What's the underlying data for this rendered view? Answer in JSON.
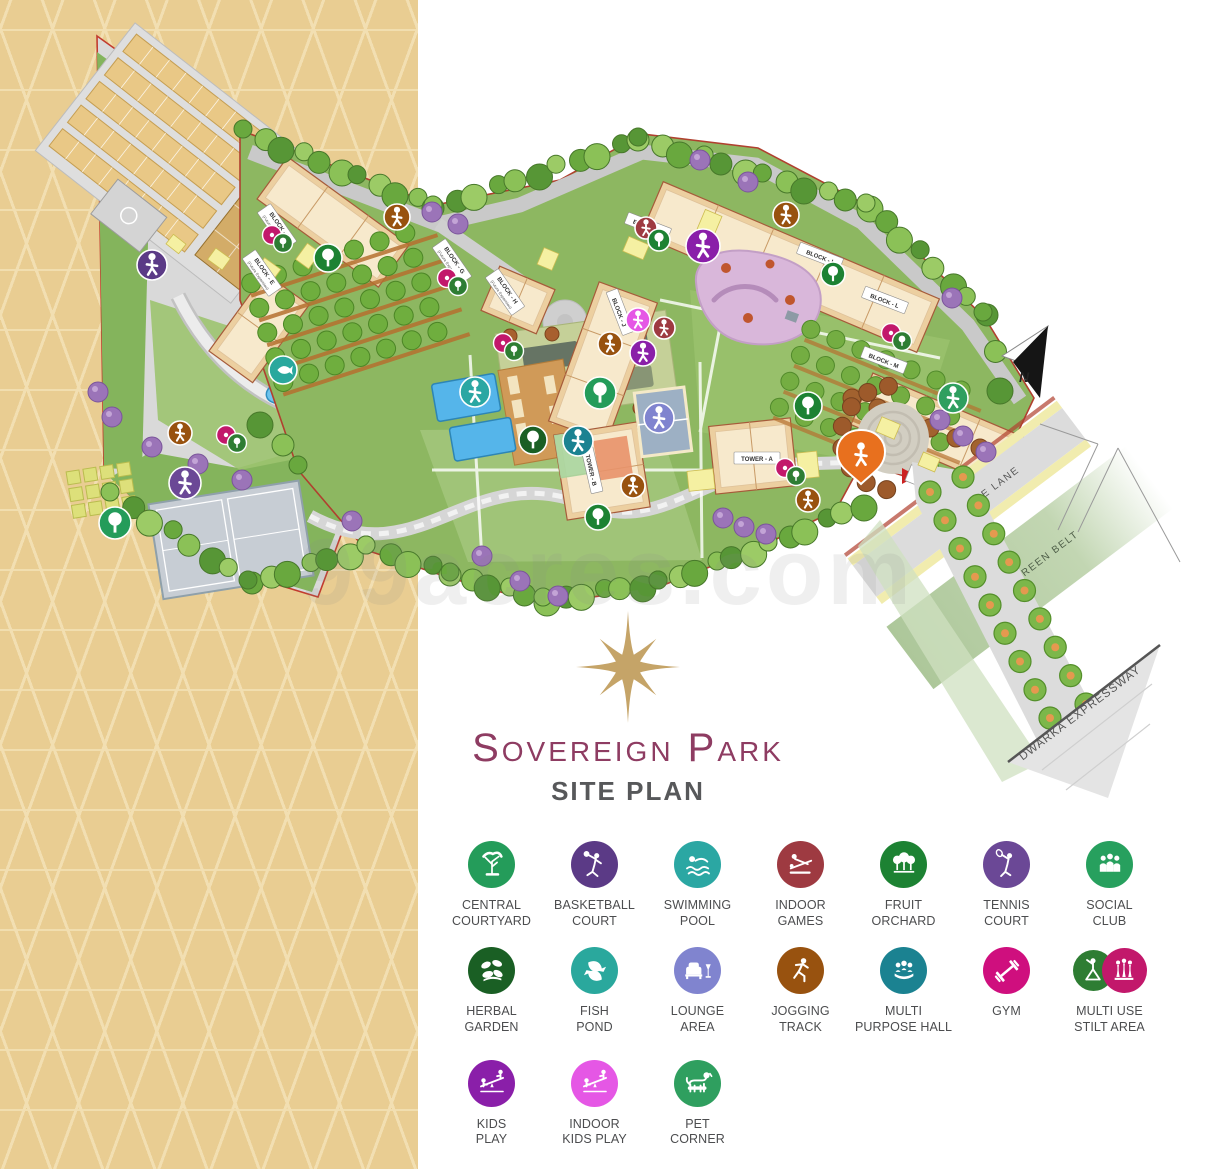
{
  "title": {
    "name": "Sovereign Park",
    "subtitle": "SITE PLAN"
  },
  "watermark": "99acres.com",
  "map": {
    "north_label": "N",
    "service_lane": "SERVICE LANE",
    "green_belt": "GREEN BELT",
    "expressway": "DWARKA EXPRESSWAY",
    "blocks": [
      {
        "label": "BLOCK - E",
        "sub": "(Future Expansion)"
      },
      {
        "label": "BLOCK - F",
        "sub": "(Future Expansion)"
      },
      {
        "label": "BLOCK - G",
        "sub": "(Future Expansion)"
      },
      {
        "label": "BLOCK - H",
        "sub": "(Future Expansion)"
      },
      {
        "label": "BLOCK - B",
        "sub": ""
      },
      {
        "label": "BLOCK - J",
        "sub": ""
      },
      {
        "label": "BLOCK - I",
        "sub": ""
      },
      {
        "label": "BLOCK - L",
        "sub": ""
      },
      {
        "label": "BLOCK - M",
        "sub": ""
      },
      {
        "label": "TOWER - A",
        "sub": ""
      },
      {
        "label": "TOWER - B",
        "sub": ""
      }
    ]
  },
  "legend": {
    "items": [
      {
        "key": "central-courtyard",
        "label": "CENTRAL\nCOURTYARD",
        "color": "#249c5a",
        "glyph": "tree"
      },
      {
        "key": "basketball-court",
        "label": "BASKETBALL\nCOURT",
        "color": "#5b3a86",
        "glyph": "basketball"
      },
      {
        "key": "swimming-pool",
        "label": "SWIMMING\nPOOL",
        "color": "#2ba7a3",
        "glyph": "swim"
      },
      {
        "key": "indoor-games",
        "label": "INDOOR\nGAMES",
        "color": "#9e3a41",
        "glyph": "billiards"
      },
      {
        "key": "fruit-orchard",
        "label": "FRUIT\nORCHARD",
        "color": "#1d8233",
        "glyph": "orchard"
      },
      {
        "key": "tennis-court",
        "label": "TENNIS\nCOURT",
        "color": "#6b4896",
        "glyph": "tennis"
      },
      {
        "key": "social-club",
        "label": "SOCIAL\nCLUB",
        "color": "#27a05e",
        "glyph": "people"
      },
      {
        "key": "herbal-garden",
        "label": "HERBAL\nGARDEN",
        "color": "#1a5f24",
        "glyph": "herbs"
      },
      {
        "key": "fish-pond",
        "label": "FISH\nPOND",
        "color": "#2aa89d",
        "glyph": "fish"
      },
      {
        "key": "lounge-area",
        "label": "LOUNGE\nAREA",
        "color": "#8084cf",
        "glyph": "lounge"
      },
      {
        "key": "jogging-track",
        "label": "JOGGING\nTRACK",
        "color": "#98520f",
        "glyph": "runner"
      },
      {
        "key": "multi-purpose-hall",
        "label": "MULTI\nPURPOSE HALL",
        "color": "#1b8291",
        "glyph": "hall"
      },
      {
        "key": "gym",
        "label": "GYM",
        "color": "#cf0f7e",
        "glyph": "dumbbell"
      },
      {
        "key": "multi-use-stilt-area",
        "label": "MULTI USE\nSTILT AREA",
        "color": "#2e7d33",
        "color2": "#c2186b",
        "glyph": "stilt"
      },
      {
        "key": "kids-play",
        "label": "KIDS\nPLAY",
        "color": "#8a1fa9",
        "glyph": "seesaw"
      },
      {
        "key": "indoor-kids-play",
        "label": "INDOOR\nKIDS PLAY",
        "color": "#e557e5",
        "glyph": "seesaw"
      },
      {
        "key": "pet-corner",
        "label": "PET\nCORNER",
        "color": "#2f9f5f",
        "glyph": "dog"
      }
    ]
  }
}
